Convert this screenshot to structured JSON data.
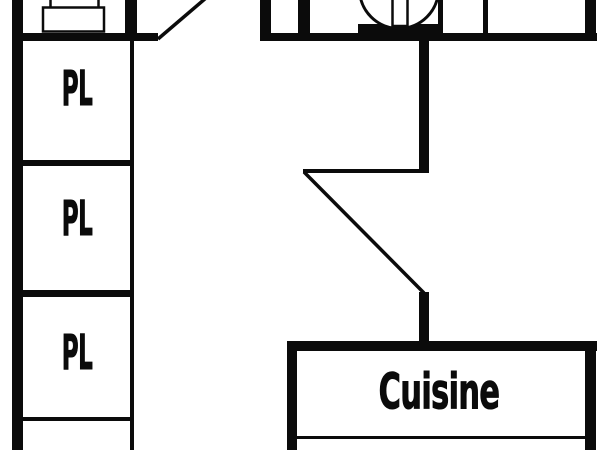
{
  "colors": {
    "background": "#ffffff",
    "wall": "#0b0b0b",
    "text": "#0b0b0b"
  },
  "rooms": {
    "closets": [
      {
        "label": "PL"
      },
      {
        "label": "PL"
      },
      {
        "label": "PL"
      }
    ],
    "kitchen": {
      "label": "Cuisine"
    }
  },
  "fixtures": [
    {
      "name": "washbasin-icon"
    },
    {
      "name": "toilet-icon"
    }
  ],
  "doors": [
    {
      "name": "door-swing-top"
    },
    {
      "name": "door-swing-middle"
    }
  ]
}
